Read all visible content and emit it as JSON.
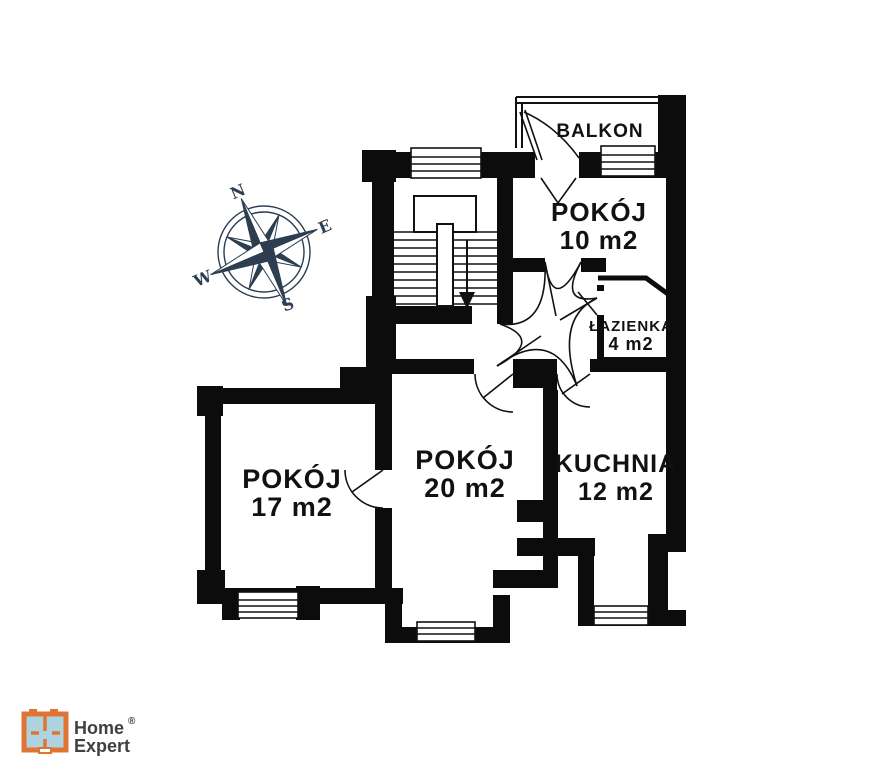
{
  "floor_plan": {
    "rooms": [
      {
        "id": "balkon",
        "name": "BALKON",
        "area": ""
      },
      {
        "id": "pokoj_10",
        "name": "POKÓJ",
        "area": "10 m2"
      },
      {
        "id": "lazienka",
        "name": "ŁAZIENKA",
        "area": "4 m2"
      },
      {
        "id": "pokoj_17",
        "name": "POKÓJ",
        "area": "17 m2"
      },
      {
        "id": "pokoj_20",
        "name": "POKÓJ",
        "area": "20 m2"
      },
      {
        "id": "kuchnia",
        "name": "KUCHNIA",
        "area": "12 m2"
      }
    ],
    "compass": {
      "north": "N",
      "east": "E",
      "south": "S",
      "west": "W"
    },
    "wall_color": "#0c0c0c",
    "compass_color": "#2c3e50"
  },
  "branding": {
    "logo_line1": "Home",
    "logo_line2": "Expert",
    "registered_mark": "®",
    "logo_orange": "#e07433",
    "logo_blue": "#aed3e0",
    "logo_text_color": "#404040"
  }
}
